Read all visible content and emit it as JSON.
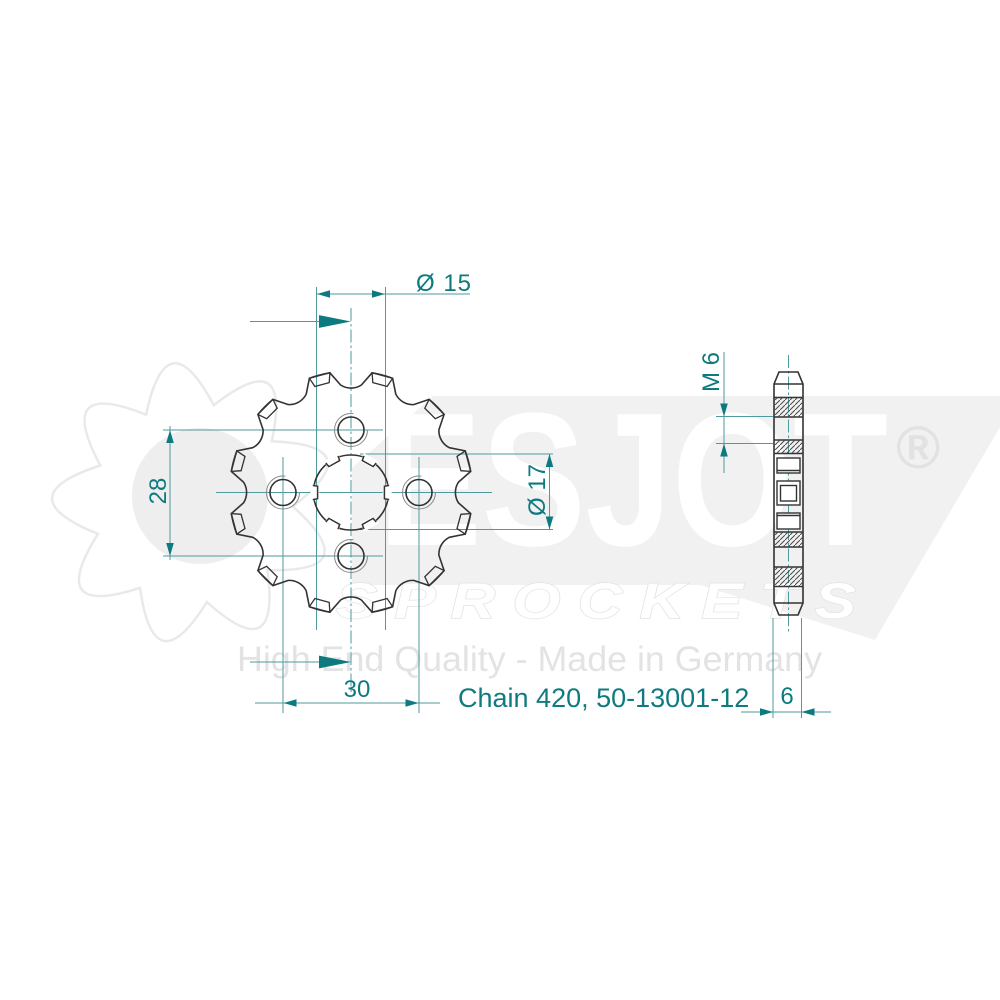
{
  "watermark": {
    "brand": "ESJOT",
    "registered": "®",
    "wordmark_sub": "S P R O C K E T S",
    "tagline": "High End Quality - Made in Germany"
  },
  "drawing": {
    "part_number": "Chain 420, 50-13001-12",
    "teeth": 12,
    "dimensions": {
      "pilot_diameter": "Ø 15",
      "hole_spacing_vertical": "28",
      "bore_diameter": "Ø 17",
      "hole_spacing_horizontal": "30",
      "thread": "M 6",
      "width": "6"
    },
    "colors": {
      "dimension": "#0c7a7f",
      "line": "#4e9a9e",
      "outline": "#333333",
      "watermark_gray": "#ededed"
    }
  }
}
